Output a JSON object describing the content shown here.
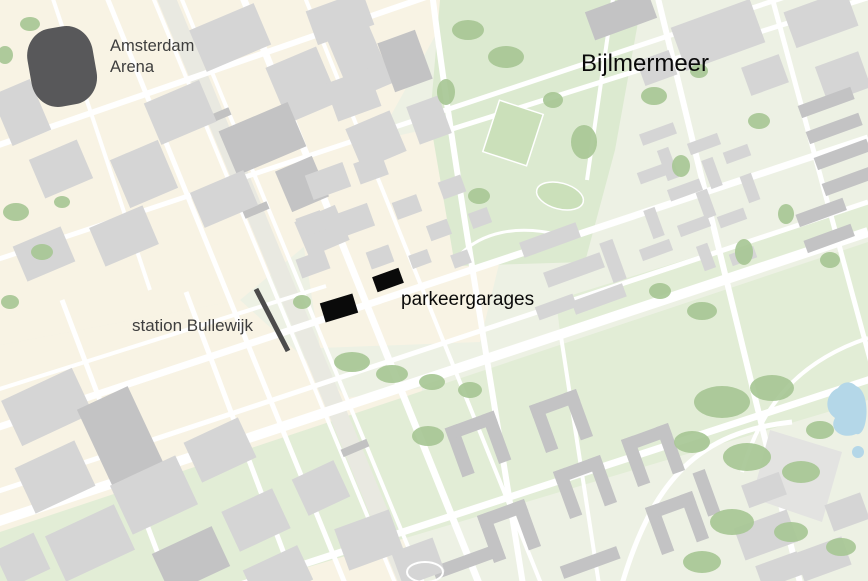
{
  "labels": {
    "arena_line1": "Amsterdam",
    "arena_line2": "Arena",
    "district": "Bijlmermeer",
    "garages": "parkeergarages",
    "station": "station Bullewijk"
  },
  "markers": {
    "arena": {
      "name": "Amsterdam Arena stadium",
      "color": "#58585a"
    },
    "parking_garages": {
      "name": "parkeergarages",
      "count": 2,
      "color": "#0a0a0a"
    },
    "station_platform": {
      "name": "station Bullewijk platform",
      "color": "#4b4b4b"
    }
  },
  "colors": {
    "land_green": "#edf1e4",
    "land_beige": "#f8f3e4",
    "park_green": "#dcead0",
    "band_green": "#e2edd6",
    "field_green": "#cbe0ba",
    "tree_green": "#a8c795",
    "road_white": "#ffffff",
    "rail_gray": "#e9e9e1",
    "building_gray": "#d5d5d5",
    "building_dark": "#c3c3c4",
    "building_light": "#dedede",
    "bridge_gray": "#c2c2c2",
    "plaza_gray": "#e3e3e1",
    "water_blue": "#b4d7e8",
    "label_dark": "#3e3e3e",
    "label_black": "#0a0a0a"
  }
}
